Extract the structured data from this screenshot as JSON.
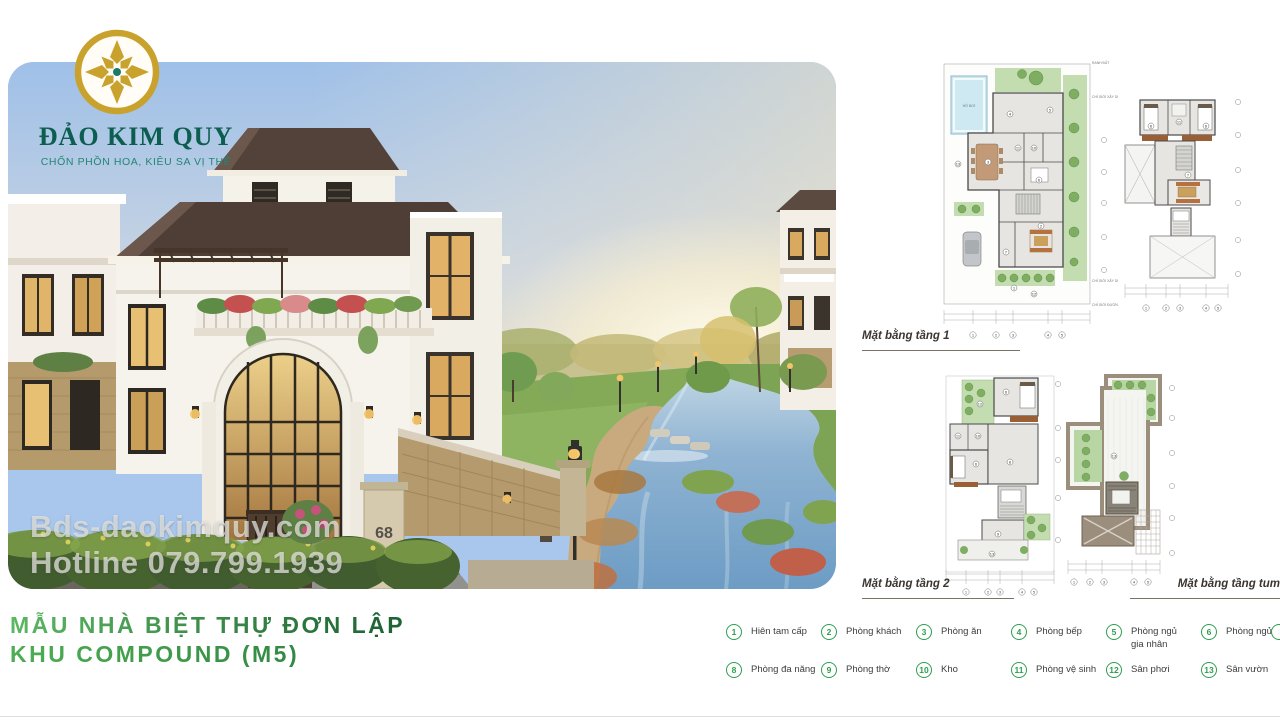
{
  "brand": {
    "name": "ĐẢO KIM QUY",
    "tagline": "CHỐN PHỒN HOA, KIÊU SA VỊ THẾ"
  },
  "photo": {
    "watermark_line1": "Bds-daokimquy.com",
    "watermark_line2": "Hotline 079.799.1939",
    "gate_number": "68"
  },
  "title": {
    "line1": "MẪU NHÀ BIỆT THỰ ĐƠN LẬP",
    "line2": "KHU COMPOUND (M5)"
  },
  "plans": {
    "floor1": {
      "label": "Mặt bằng tầng 1",
      "pool": "HỒ BƠI",
      "annotations": [
        "RANH ĐẤT",
        "CHỈ GIỚI XÂY DỰNG",
        "CHỈ GIỚI XÂY DỰNG",
        "CHỈ GIỚI ĐƯỜNG ĐỎ"
      ],
      "axis": [
        "1",
        "2",
        "3",
        "4",
        "5"
      ],
      "rooms": [
        "13",
        "4",
        "5",
        "3",
        "11",
        "10",
        "6",
        "7",
        "2",
        "1",
        "12"
      ]
    },
    "upper": {
      "axis": [
        "1",
        "2",
        "3",
        "4",
        "5"
      ],
      "rooms": [
        "6",
        "11",
        "6",
        "7"
      ]
    },
    "floor2": {
      "label": "Mặt bằng tầng 2",
      "axis": [
        "1",
        "2",
        "3",
        "4",
        "5"
      ],
      "rooms": [
        "12",
        "6",
        "11",
        "10",
        "6",
        "8",
        "9",
        "13"
      ]
    },
    "tum": {
      "label": "Mặt bằng tầng tum",
      "axis": [
        "1",
        "2",
        "3",
        "4",
        "5"
      ],
      "rooms": [
        "13"
      ]
    }
  },
  "legend": {
    "items": [
      {
        "num": "1",
        "label": "Hiên tam cấp"
      },
      {
        "num": "2",
        "label": "Phòng khách"
      },
      {
        "num": "3",
        "label": "Phòng ăn"
      },
      {
        "num": "4",
        "label": "Phòng bếp"
      },
      {
        "num": "5",
        "label": "Phòng ngủ",
        "label2": "gia nhân"
      },
      {
        "num": "6",
        "label": "Phòng ngủ"
      },
      {
        "num": "8",
        "label": "Phòng đa năng"
      },
      {
        "num": "9",
        "label": "Phòng thờ"
      },
      {
        "num": "10",
        "label": "Kho"
      },
      {
        "num": "11",
        "label": "Phòng vệ sinh"
      },
      {
        "num": "12",
        "label": "Sân phơi"
      },
      {
        "num": "13",
        "label": "Sân vườn"
      }
    ]
  }
}
